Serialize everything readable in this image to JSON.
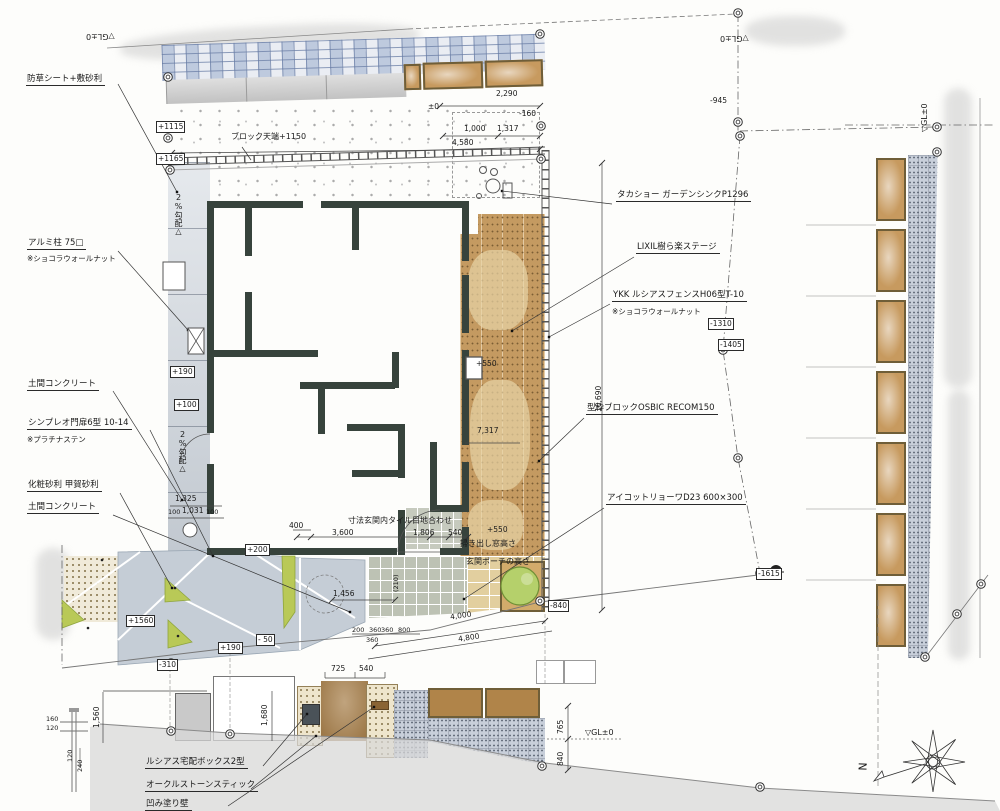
{
  "ann_left": [
    {
      "label": "防草シート+敷砂利"
    },
    {
      "label": "アルミ柱 75□",
      "note": "※ショコラウォールナット"
    },
    {
      "label": "土間コンクリート"
    },
    {
      "label": "シンプレオ門扉6型 10-14",
      "note": "※プラチナステン"
    },
    {
      "label": "化粧砂利 甲賀砂利"
    },
    {
      "label": "土間コンクリート"
    },
    {
      "label": "ルシアス宅配ボックス2型"
    },
    {
      "label": "オークルストーンスティック"
    },
    {
      "label": "凹み塗り壁"
    }
  ],
  "ann_right": [
    {
      "label": "タカショー ガーデンシンクP1296"
    },
    {
      "label": "LIXIL樹ら楽ステージ"
    },
    {
      "label": "YKK ルシアスフェンスH06型T-10",
      "note": "※ショコラウォールナット"
    },
    {
      "label": "型枠ブロックOSBIC RECOM150"
    },
    {
      "label": "アイコットリョーワD23 600×300"
    }
  ],
  "ann_misc": {
    "block_top": "ブロック天端+1150",
    "tile_align": "寸法玄関内タイル目地合わせ",
    "window_height": "掃き出し窓高さ",
    "porch_height": "玄関ポーチの高さ",
    "slope": "2%勾配△"
  },
  "levels_boxed": [
    "+1115",
    "+1165",
    "+190",
    "+100",
    "+200",
    "+1560",
    "-310",
    "+190",
    "- 50",
    "-840",
    "-1310",
    "-1405",
    "-1615"
  ],
  "levels_free": [
    "±0",
    "-160",
    "-945",
    "+550",
    "+550"
  ],
  "gl_mark": "▽GL±0",
  "dims": [
    "2,290",
    "1,000",
    "1,317",
    "4,580",
    "1,325",
    "100",
    "1,031",
    "100",
    "400",
    "3,600",
    "1,806",
    "540",
    "1,456",
    "200",
    "360",
    "360",
    "800",
    "360",
    "4,000",
    "4,800",
    "7,317",
    "10,690",
    "725",
    "540",
    "1,680",
    "1,560",
    "160",
    "120",
    "120",
    "240",
    "765",
    "840",
    "(210)"
  ],
  "north_letter": "N"
}
